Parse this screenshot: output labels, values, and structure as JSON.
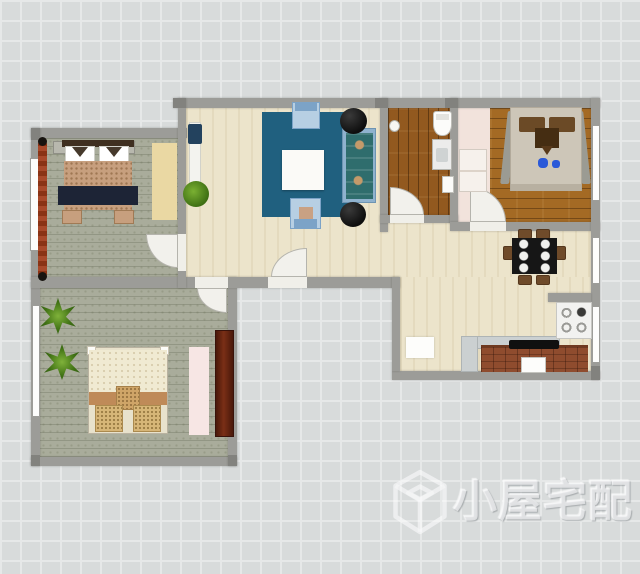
{
  "watermark": {
    "text": "小屋宅配",
    "logo": "isometric-cube-logo"
  },
  "palette": {
    "grid_bg": "#d8dbdb",
    "grid_line": "#e6e8e8",
    "wall": "#9c9c98",
    "wall_dark": "#82827e",
    "floor_cream": "#ece4cb",
    "floor_green": "#a9ac9b",
    "wood_dark": "#92591f",
    "wood_mid": "#a46a24",
    "floor_pink": "#f2e3dc",
    "rug_blue": "#20607f",
    "sofa_frame": "#8fb2ce",
    "chair_blue": "#b7cfe3",
    "cushion_teal": "#2f6d6d",
    "white": "#fbfaf7",
    "bed_tan": "#c79f7e",
    "navy": "#1d2436",
    "bed3_cream": "#f0ead2",
    "bed3_stripe": "#bf8a58",
    "pillow_tan": "#d7b678",
    "wardrobe": "#6b2413",
    "rug_pink": "#f7e6e4",
    "counter_brown": "#8f4c2e",
    "counter_gray": "#cbd0d1",
    "plant_green": "#4c8420",
    "chair_brown": "#6f4b2a",
    "dining_black": "#161616",
    "ladder_red": "#8a3315",
    "watermark_color": "rgba(252,252,253,0.62)"
  }
}
